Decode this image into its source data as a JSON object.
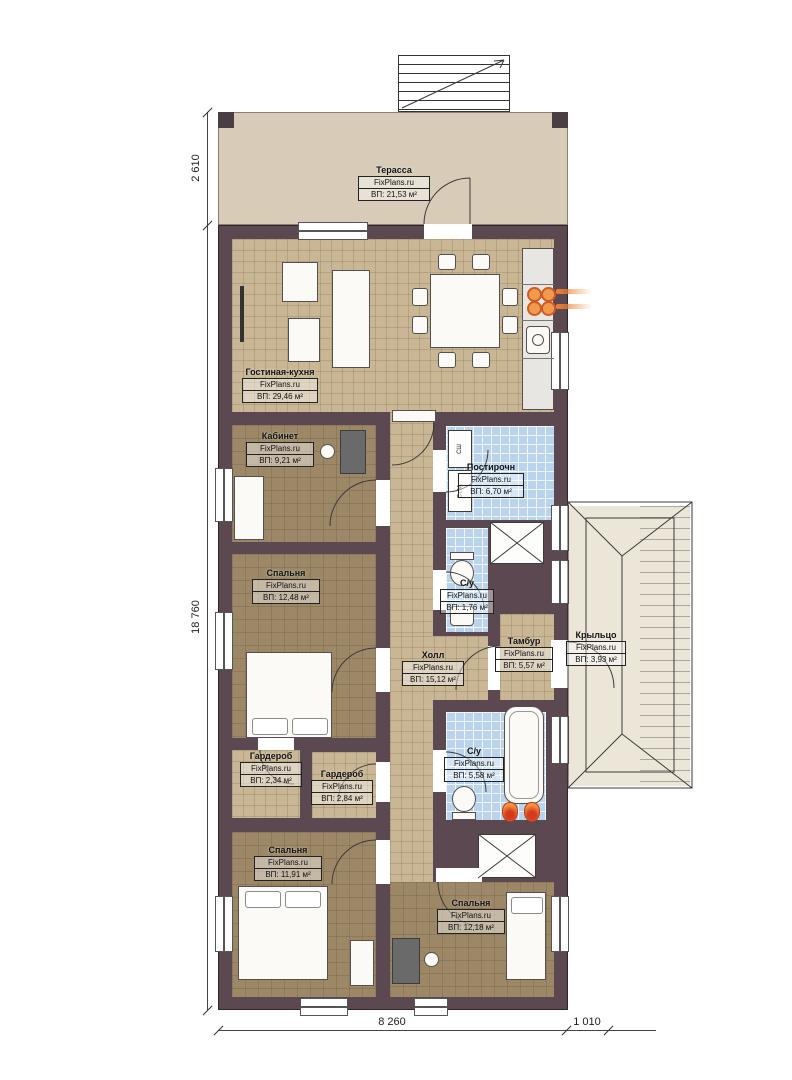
{
  "plan": {
    "watermark": "FixPlans.ru",
    "rooms": [
      {
        "id": "terrace",
        "name": "Терасса",
        "area": "ВП: 21,53 м²"
      },
      {
        "id": "living-kitchen",
        "name": "Гостиная-кухня",
        "area": "ВП: 29,46 м²"
      },
      {
        "id": "office",
        "name": "Кабинет",
        "area": "ВП: 9,21 м²"
      },
      {
        "id": "bedroom-left",
        "name": "Спальня",
        "area": "ВП: 12,48 м²"
      },
      {
        "id": "laundry",
        "name": "Постирочн",
        "area": "ВП: 6,70 м²"
      },
      {
        "id": "wc-small",
        "name": "С/у",
        "area": "ВП: 1,76 м²"
      },
      {
        "id": "hall",
        "name": "Холл",
        "area": "ВП: 15,12 м²"
      },
      {
        "id": "vestibule",
        "name": "Тамбур",
        "area": "ВП: 5,57 м²"
      },
      {
        "id": "porch",
        "name": "Крыльцо",
        "area": "ВП: 3,93 м²"
      },
      {
        "id": "wardrobe-1",
        "name": "Гардероб",
        "area": "ВП: 2,34 м²"
      },
      {
        "id": "wardrobe-2",
        "name": "Гардероб",
        "area": "ВП: 2,84 м²"
      },
      {
        "id": "wc-big",
        "name": "С/у",
        "area": "ВП: 5,58 м²"
      },
      {
        "id": "bedroom-bottom-left",
        "name": "Спальня",
        "area": "ВП: 11,91 м²"
      },
      {
        "id": "bedroom-bottom-right",
        "name": "Спальня",
        "area": "ВП: 12,18 м²"
      }
    ],
    "appliances": {
      "dryer": "СШ",
      "washer": "Ст.М."
    },
    "dimensions": {
      "terrace_height": "2 610",
      "house_height": "18 760",
      "house_width": "8 260",
      "porch_width": "1 010"
    },
    "colors": {
      "wall": "#5c4850",
      "tile_beige": "#c9b694",
      "tile_brown": "#9c8766",
      "tile_blue": "#b9d4ec",
      "terrace": "#d8ccb9",
      "porch": "#ece6d9",
      "accent_orange": "#e8762d"
    }
  }
}
